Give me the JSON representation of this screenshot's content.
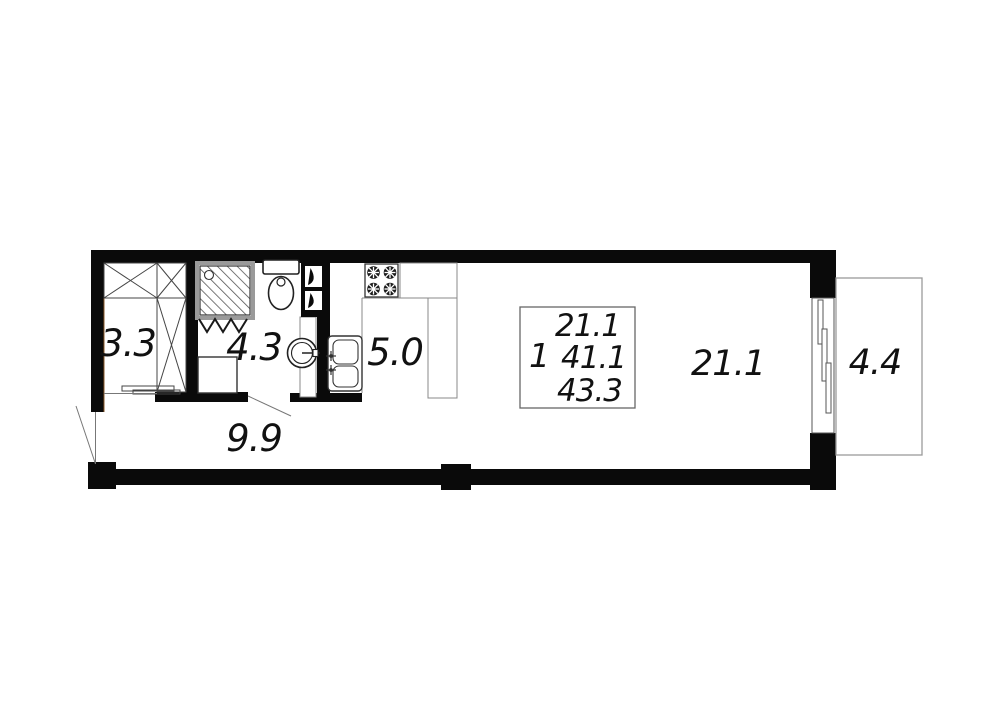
{
  "floorplan": {
    "rooms": [
      {
        "name": "wardrobe",
        "area_label": "3.3"
      },
      {
        "name": "bathroom",
        "area_label": "4.3"
      },
      {
        "name": "kitchen",
        "area_label": "5.0"
      },
      {
        "name": "hallway",
        "area_label": "9.9"
      },
      {
        "name": "living-room",
        "area_label": "21.1"
      },
      {
        "name": "balcony",
        "area_label": "4.4"
      }
    ],
    "summary_box": {
      "rooms_count": "1",
      "living_area": "21.1",
      "apartment_area": "41.1",
      "total_area": "43.3"
    },
    "colors": {
      "wall": "#0a0a0a",
      "fixture_line": "#333333",
      "thin_line": "#777777",
      "balcony_line": "#9a9a9a",
      "background": "#ffffff"
    }
  }
}
